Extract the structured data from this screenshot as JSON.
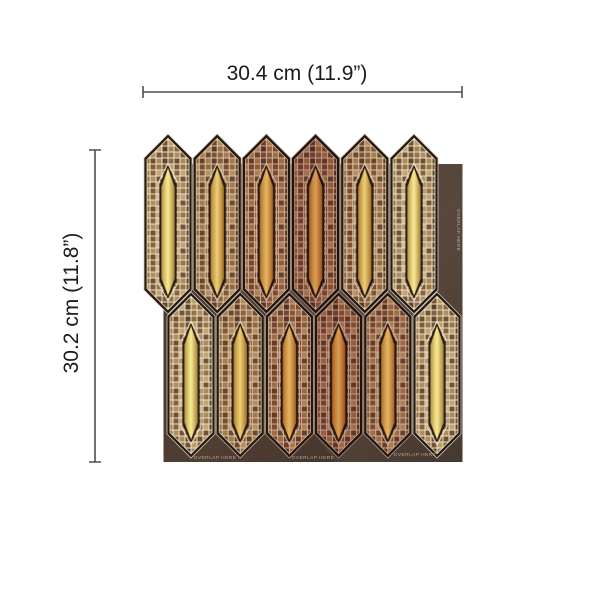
{
  "dimensions": {
    "width_label": "30.4 cm (11.9”)",
    "height_label": "30.2  cm (11.8”)"
  },
  "tile_sheet": {
    "overlap_label": "OVERLAP HERE",
    "overlap_label_positions": [
      "bottom-left",
      "bottom-center",
      "bottom-right",
      "right-edge-vertical"
    ],
    "rows": 2,
    "pickets_per_row": 6,
    "colors": {
      "backing": "#46352b",
      "grout_dark": "#241710",
      "grout_light": "#d6c8ac",
      "gold_center": "#ddb95c",
      "gold_edge": "#a8803a",
      "mosaic_palette": [
        "#8a5c38",
        "#6b4428",
        "#a5794a",
        "#5d3c26",
        "#b28a58",
        "#7c4e30",
        "#96653d",
        "#9d7045",
        "#845434",
        "#b6905e",
        "#5a3822",
        "#8e6240"
      ]
    }
  }
}
